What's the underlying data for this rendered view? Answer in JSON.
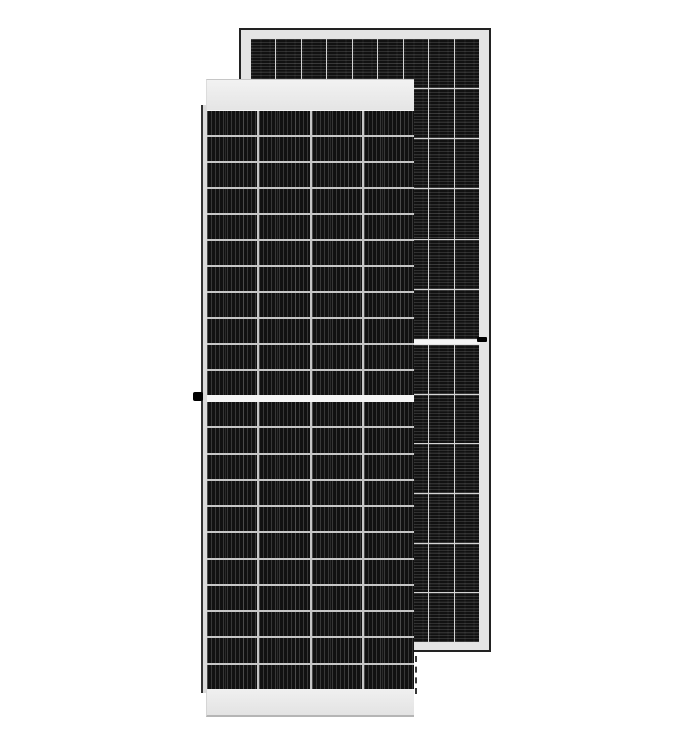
{
  "scene": {
    "type": "product-photo",
    "subject": "Two half-cut-cell monocrystalline solar PV modules standing upright, front module overlapping a taller rear module, on a plain white background",
    "background_color": "#ffffff",
    "text_content": "none"
  },
  "colors": {
    "cell_base": "#111111",
    "separator_back": "#d4d4d4",
    "separator_front": "#c6c6c6",
    "back_frame": "#e4e4e4",
    "back_edge": "#222222",
    "front_edge_line": "#333333",
    "center_gap": "#f5f5f5",
    "marker_black": "#000000",
    "bottom_shadow": "#b5b5b5"
  },
  "panels": {
    "back": {
      "name": "rear-solar-panel",
      "description": "Taller rear module, dark outer edge with light aluminum frame, horizontal busbar striping on cells, black junction tick on right frame at the half-cut center gap",
      "columns": 9,
      "rows_per_half": 6,
      "halves": 2,
      "stripe_direction": "horizontal"
    },
    "front": {
      "name": "front-solar-panel",
      "description": "Front module with white top and bottom frame rails, vertical busbar striping on cells, black grounding lug on left frame at the half-cut center gap, dashed shadow at lower right edge",
      "columns": 4,
      "rows_per_half": 11,
      "halves": 2,
      "stripe_direction": "vertical"
    }
  }
}
